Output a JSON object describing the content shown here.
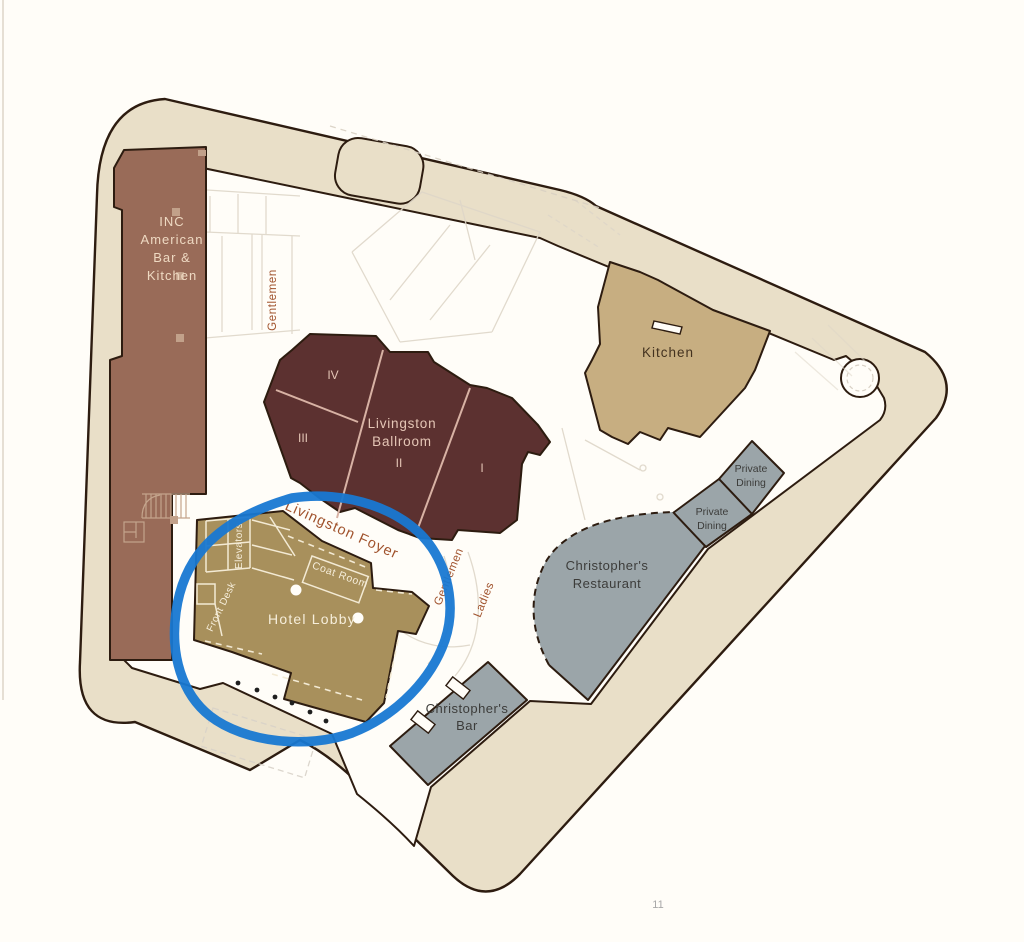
{
  "page": {
    "number": "11"
  },
  "colors": {
    "background": "#fffdf8",
    "wall_band": "#e9dfc8",
    "outline": "#2d1c10",
    "inc_brown": "#996b58",
    "ballroom_maroon": "#5c3130",
    "kitchen_tan": "#c7ae81",
    "lobby_olive": "#a8905c",
    "dining_gray": "#9ba5a9",
    "annotation_blue": "#1878d2",
    "rust_text": "#a0522c",
    "faint_wall": "#ded6c8"
  },
  "labels": {
    "inc": {
      "line1": "INC",
      "line2": "American",
      "line3": "Bar &",
      "line4": "Kitchen"
    },
    "restrooms_upper": {
      "ladies": "Ladies",
      "gentlemen": "Gentlemen"
    },
    "restrooms_mid": {
      "ladies": "Ladies",
      "gentlemen": "Gentlemen"
    },
    "ballroom": {
      "line1": "Livingston",
      "line2": "Ballroom",
      "sections": [
        "I",
        "II",
        "III",
        "IV"
      ]
    },
    "foyer": "Livingston Foyer",
    "kitchen": "Kitchen",
    "private_dining": {
      "line1": "Private",
      "line2": "Dining"
    },
    "restaurant": {
      "line1": "Christopher's",
      "line2": "Restaurant"
    },
    "bar": {
      "line1": "Christopher's",
      "line2": "Bar"
    },
    "lobby": {
      "name": "Hotel Lobby",
      "coat_room": "Coat Room",
      "elevators": "Elevators",
      "front_desk": "Front Desk"
    }
  },
  "annotation": {
    "shape": "hand-drawn loop",
    "target": "Hotel Lobby",
    "color": "#1878d2"
  }
}
